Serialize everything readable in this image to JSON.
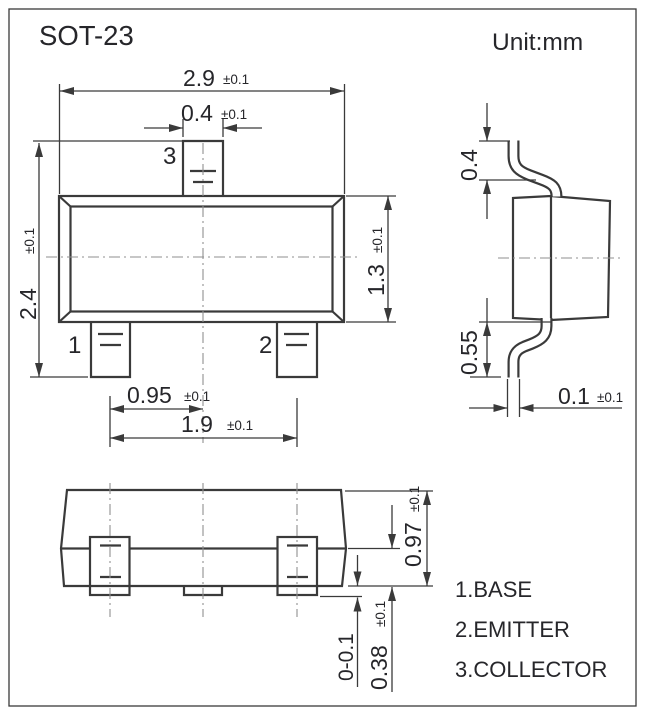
{
  "title": "SOT-23",
  "unit_label": "Unit:mm",
  "colors": {
    "line": "#3a3a3a",
    "text": "#26262a",
    "centerline": "#8f8f8f",
    "background": "#ffffff"
  },
  "top_view": {
    "dim_overall_width": {
      "value": "2.9",
      "tol": "±0.1"
    },
    "dim_pin_width": {
      "value": "0.4",
      "tol": "±0.1"
    },
    "dim_overall_height": {
      "value": "2.4",
      "tol": "±0.1"
    },
    "dim_body_height": {
      "value": "1.3",
      "tol": "±0.1"
    },
    "dim_pin_pitch": {
      "value": "0.95",
      "tol": "±0.1"
    },
    "dim_pin_span": {
      "value": "1.9",
      "tol": "±0.1"
    },
    "pin_labels": {
      "pin1": "1",
      "pin2": "2",
      "pin3": "3"
    }
  },
  "side_view": {
    "dim_lead_top": {
      "value": "0.4"
    },
    "dim_lead_bottom": {
      "value": "0.55"
    },
    "dim_lead_thickness": {
      "value": "0.1",
      "tol": "±0.1"
    }
  },
  "front_view": {
    "dim_total_height": {
      "value": "0.97",
      "tol": "±0.1"
    },
    "dim_lead_height": {
      "value": "0.38",
      "tol": "±0.1"
    },
    "dim_standoff": {
      "value": "0-0.1"
    }
  },
  "legend": {
    "items": [
      {
        "label": "1.BASE"
      },
      {
        "label": "2.EMITTER"
      },
      {
        "label": "3.COLLECTOR"
      }
    ]
  }
}
